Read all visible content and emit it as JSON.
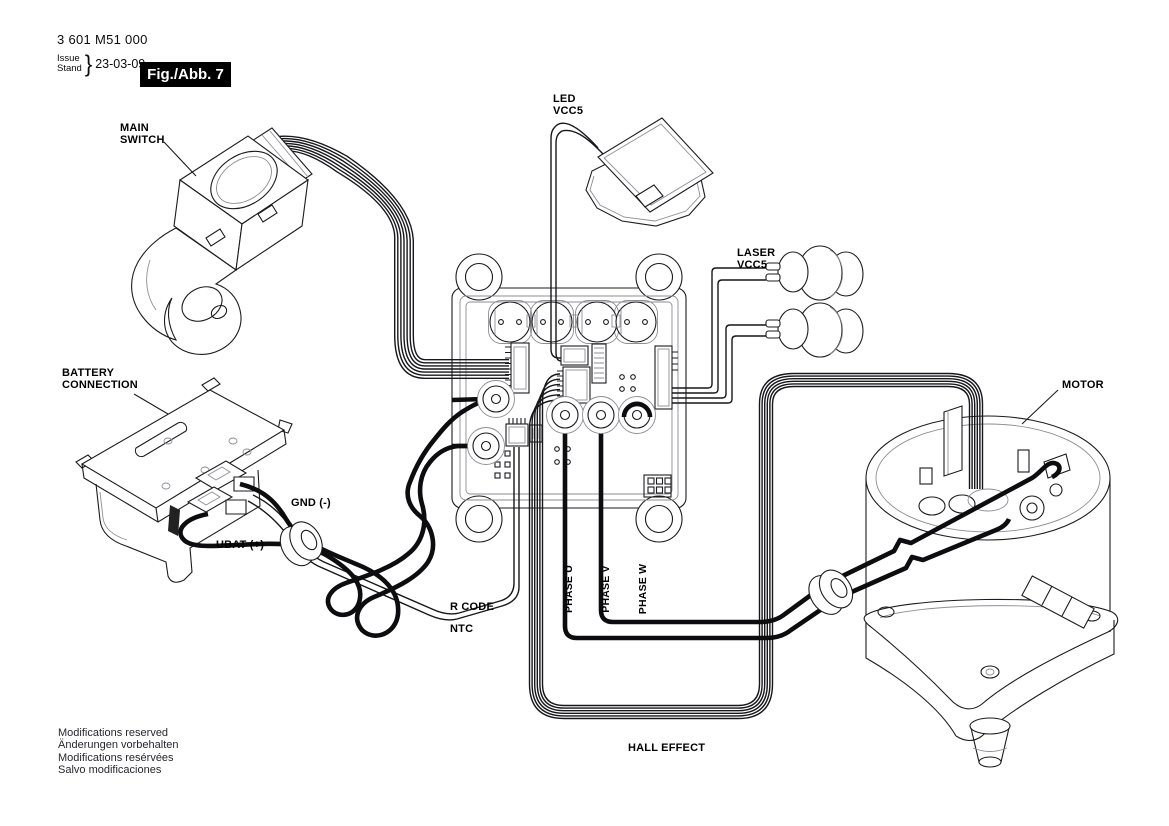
{
  "header": {
    "part_number": "3 601 M51 000",
    "issue_label": "Issue",
    "stand_label": "Stand",
    "brace": "}",
    "date": "23-03-09",
    "figure_label": "Fig./Abb. 7"
  },
  "labels": {
    "main_switch_line1": "MAIN",
    "main_switch_line2": "SWITCH",
    "battery_line1": "BATTERY",
    "battery_line2": "CONNECTION",
    "led_line1": "LED",
    "led_line2": "VCC5",
    "laser_line1": "LASER",
    "laser_line2": "VCC5",
    "gnd": "GND (-)",
    "ubat": "UBAT (+)",
    "r_code": "R CODE",
    "ntc": "NTC",
    "motor": "MOTOR",
    "phase_u": "PHASE U",
    "phase_v": "PHASE V",
    "phase_w": "PHASE W",
    "hall_effect": "HALL EFFECT"
  },
  "footer": {
    "lines": [
      "Modifications reserved",
      "Änderungen vorbehalten",
      "Modifications resérvées",
      "Salvo modificaciones"
    ]
  },
  "colors": {
    "background": "#ffffff",
    "line": "#1c1c1e",
    "thick_wire": "#0d0d0f",
    "fig_box_bg": "#000000",
    "fig_box_text": "#ffffff",
    "label_text": "#000000"
  }
}
